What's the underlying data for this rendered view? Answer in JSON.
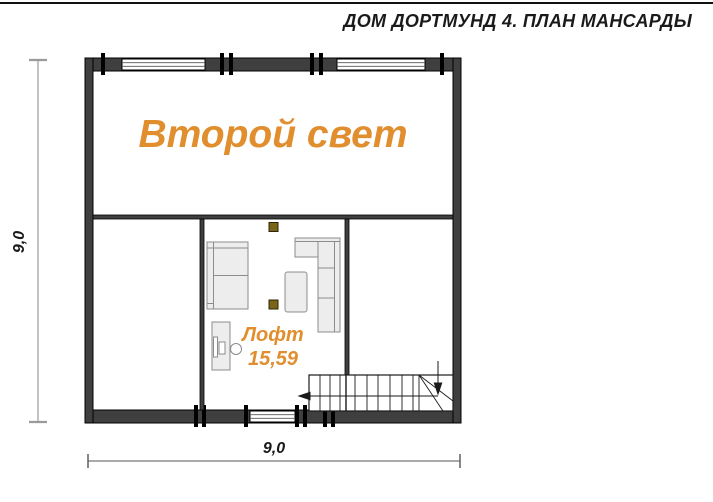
{
  "header": {
    "title": "ДОМ ДОРТМУНД 4. ПЛАН МАНСАРДЫ"
  },
  "plan": {
    "second_light_label": "Второй свет",
    "loft": {
      "name": "Лофт",
      "area": "15,59"
    },
    "dimensions": {
      "width_bottom": "9,0",
      "height_left": "9,0"
    },
    "icons": [
      "stair-walkline-arrow-icon",
      "stair-direction-arrow-icon"
    ],
    "rooms": [
      {
        "name": "Второй свет"
      },
      {
        "name": "Лофт",
        "area_m2": "15,59"
      }
    ]
  },
  "colors": {
    "accent_orange": "#E08E2E",
    "wall_fill": "#3f3f3f",
    "beam_brown": "#7a6418",
    "furniture_fill": "#ededed",
    "dimension_line": "#999999"
  }
}
